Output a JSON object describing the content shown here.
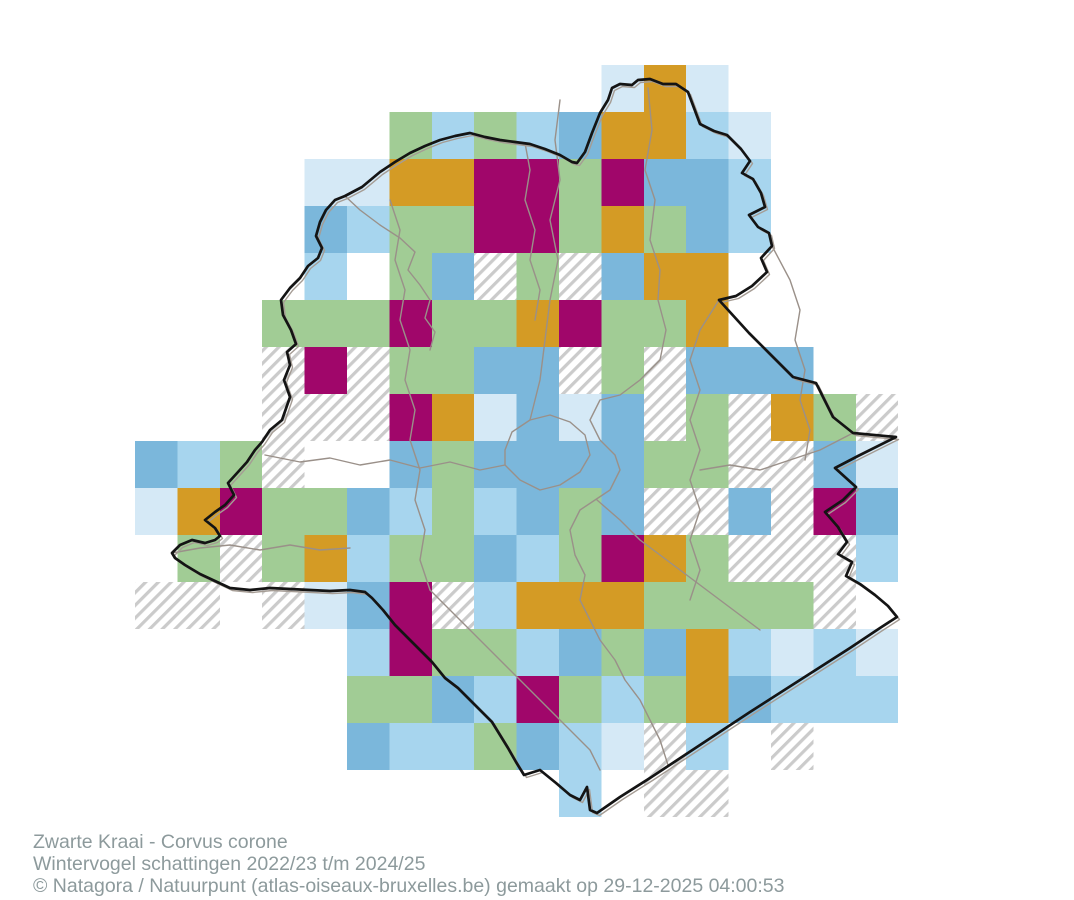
{
  "page": {
    "background": "#FFFFFF"
  },
  "caption": {
    "species": "Zwarte Kraai - Corvus corone",
    "subtitle": "Wintervogel schattingen 2022/23 t/m 2024/25",
    "copyright": "© Natagora / Natuurpunt (atlas-oiseaux-bruxelles.be) gemaakt op 29-12-2025 04:00:53",
    "text_color": "#8D9A9C"
  },
  "map": {
    "grid": {
      "columns": 18,
      "rows": 16,
      "origin_x": 135,
      "origin_y": 65,
      "cell_width": 42.4,
      "cell_height": 47,
      "cells": [
        "WWWWWWWWWWWPOPWWWW",
        "WWWWWWGLGLMOOLPWWW",
        "WWWWPPOOXXGXMMLWWW",
        "WWWWMLGGXXGOGMLWWW",
        "WWWWLWGMHGHMOOWWWW",
        "WWWGGGXGGOXGGOWWWW",
        "WWWHXHGGMMHGHMMMWW",
        "WWWHHHXOPMPMHGHOGH",
        "MLGHWWMGMMMMGGHHMP",
        "POXGGMLGLMGMHHMHXM",
        "WGHGOLGGMLGXOGHHHL",
        "HHWHPMXHLOOOGGGGHW",
        "WWWWWLXGGLMGMOLPLP",
        "WWWWWGGMLXGLGOMLLL",
        "WWWWWMLLGMLPHLWHWW",
        "WWWWWWWWWWLWHHWWWW"
      ],
      "palette": {
        "W": null,
        "H": "hatch",
        "P": "#D5E9F6",
        "L": "#A7D5EE",
        "M": "#7BB7DB",
        "G": "#A1CC95",
        "O": "#D49B25",
        "X": "#A0066A"
      },
      "hatch_line_color": "#CBCBCB"
    },
    "outline_color": "#141414",
    "outline_shadow_color": "#A59C94",
    "boundary_color": "#9A9089",
    "outline": [
      [
        608,
        100
      ],
      [
        612,
        88
      ],
      [
        620,
        84
      ],
      [
        632,
        85
      ],
      [
        638,
        80
      ],
      [
        650,
        79
      ],
      [
        663,
        84
      ],
      [
        676,
        84
      ],
      [
        688,
        92
      ],
      [
        694,
        108
      ],
      [
        700,
        124
      ],
      [
        714,
        131
      ],
      [
        727,
        135
      ],
      [
        741,
        149
      ],
      [
        750,
        161
      ],
      [
        742,
        173
      ],
      [
        753,
        179
      ],
      [
        761,
        193
      ],
      [
        765,
        207
      ],
      [
        749,
        215
      ],
      [
        758,
        227
      ],
      [
        769,
        233
      ],
      [
        772,
        246
      ],
      [
        761,
        258
      ],
      [
        767,
        272
      ],
      [
        752,
        286
      ],
      [
        736,
        296
      ],
      [
        719,
        300
      ],
      [
        749,
        333
      ],
      [
        769,
        353
      ],
      [
        793,
        377
      ],
      [
        816,
        383
      ],
      [
        833,
        417
      ],
      [
        853,
        433
      ],
      [
        896,
        437
      ],
      [
        858,
        456
      ],
      [
        835,
        468
      ],
      [
        856,
        487
      ],
      [
        843,
        500
      ],
      [
        825,
        512
      ],
      [
        838,
        527
      ],
      [
        847,
        542
      ],
      [
        838,
        554
      ],
      [
        852,
        562
      ],
      [
        846,
        576
      ],
      [
        860,
        584
      ],
      [
        875,
        595
      ],
      [
        888,
        606
      ],
      [
        897,
        617
      ],
      [
        880,
        628
      ],
      [
        850,
        648
      ],
      [
        800,
        680
      ],
      [
        750,
        712
      ],
      [
        700,
        745
      ],
      [
        650,
        778
      ],
      [
        620,
        797
      ],
      [
        597,
        813
      ],
      [
        590,
        810
      ],
      [
        587,
        787
      ],
      [
        580,
        800
      ],
      [
        570,
        795
      ],
      [
        556,
        783
      ],
      [
        540,
        770
      ],
      [
        524,
        775
      ],
      [
        516,
        762
      ],
      [
        508,
        748
      ],
      [
        500,
        735
      ],
      [
        492,
        722
      ],
      [
        480,
        710
      ],
      [
        470,
        700
      ],
      [
        458,
        688
      ],
      [
        445,
        678
      ],
      [
        432,
        662
      ],
      [
        420,
        650
      ],
      [
        406,
        636
      ],
      [
        395,
        625
      ],
      [
        383,
        610
      ],
      [
        372,
        598
      ],
      [
        365,
        592
      ],
      [
        350,
        590
      ],
      [
        330,
        591
      ],
      [
        310,
        590
      ],
      [
        290,
        589
      ],
      [
        270,
        588
      ],
      [
        250,
        590
      ],
      [
        230,
        588
      ],
      [
        215,
        581
      ],
      [
        200,
        574
      ],
      [
        185,
        565
      ],
      [
        175,
        558
      ],
      [
        172,
        553
      ],
      [
        180,
        545
      ],
      [
        192,
        540
      ],
      [
        205,
        543
      ],
      [
        215,
        540
      ],
      [
        220,
        536
      ],
      [
        215,
        528
      ],
      [
        205,
        520
      ],
      [
        215,
        512
      ],
      [
        225,
        505
      ],
      [
        234,
        495
      ],
      [
        228,
        483
      ],
      [
        238,
        472
      ],
      [
        247,
        462
      ],
      [
        255,
        450
      ],
      [
        262,
        442
      ],
      [
        270,
        430
      ],
      [
        282,
        420
      ],
      [
        290,
        397
      ],
      [
        284,
        380
      ],
      [
        290,
        365
      ],
      [
        287,
        352
      ],
      [
        296,
        344
      ],
      [
        291,
        330
      ],
      [
        283,
        315
      ],
      [
        281,
        300
      ],
      [
        290,
        288
      ],
      [
        300,
        278
      ],
      [
        308,
        266
      ],
      [
        318,
        258
      ],
      [
        322,
        248
      ],
      [
        316,
        236
      ],
      [
        320,
        222
      ],
      [
        326,
        210
      ],
      [
        335,
        200
      ],
      [
        345,
        196
      ],
      [
        362,
        187
      ],
      [
        380,
        172
      ],
      [
        395,
        162
      ],
      [
        410,
        153
      ],
      [
        425,
        146
      ],
      [
        440,
        140
      ],
      [
        455,
        136
      ],
      [
        470,
        133
      ],
      [
        485,
        137
      ],
      [
        500,
        140
      ],
      [
        515,
        142
      ],
      [
        530,
        144
      ],
      [
        545,
        149
      ],
      [
        560,
        155
      ],
      [
        572,
        162
      ],
      [
        577,
        163
      ],
      [
        585,
        152
      ],
      [
        592,
        133
      ],
      [
        600,
        113
      ]
    ],
    "boundaries": [
      [
        [
          648,
          88
        ],
        [
          652,
          130
        ],
        [
          645,
          170
        ],
        [
          655,
          200
        ],
        [
          650,
          240
        ],
        [
          660,
          270
        ],
        [
          658,
          300
        ],
        [
          666,
          330
        ],
        [
          660,
          360
        ],
        [
          640,
          380
        ],
        [
          620,
          395
        ],
        [
          600,
          400
        ],
        [
          590,
          420
        ],
        [
          600,
          440
        ],
        [
          615,
          455
        ],
        [
          620,
          470
        ],
        [
          610,
          490
        ],
        [
          595,
          500
        ],
        [
          580,
          510
        ],
        [
          570,
          530
        ],
        [
          575,
          555
        ],
        [
          585,
          575
        ],
        [
          580,
          600
        ],
        [
          590,
          620
        ],
        [
          600,
          640
        ],
        [
          615,
          660
        ],
        [
          625,
          680
        ],
        [
          640,
          700
        ],
        [
          650,
          720
        ],
        [
          660,
          740
        ],
        [
          668,
          765
        ]
      ],
      [
        [
          390,
          200
        ],
        [
          400,
          230
        ],
        [
          395,
          260
        ],
        [
          405,
          290
        ],
        [
          400,
          320
        ],
        [
          410,
          350
        ],
        [
          405,
          380
        ],
        [
          415,
          410
        ],
        [
          410,
          440
        ],
        [
          420,
          470
        ],
        [
          415,
          500
        ],
        [
          425,
          530
        ],
        [
          420,
          560
        ],
        [
          430,
          590
        ]
      ],
      [
        [
          265,
          455
        ],
        [
          300,
          462
        ],
        [
          330,
          458
        ],
        [
          360,
          465
        ],
        [
          390,
          460
        ],
        [
          420,
          468
        ],
        [
          450,
          462
        ],
        [
          480,
          470
        ],
        [
          505,
          465
        ]
      ],
      [
        [
          505,
          465
        ],
        [
          520,
          480
        ],
        [
          540,
          490
        ],
        [
          560,
          485
        ],
        [
          580,
          472
        ],
        [
          590,
          455
        ],
        [
          585,
          435
        ],
        [
          570,
          422
        ],
        [
          550,
          415
        ],
        [
          530,
          420
        ],
        [
          512,
          432
        ],
        [
          505,
          450
        ],
        [
          505,
          465
        ]
      ],
      [
        [
          560,
          100
        ],
        [
          555,
          140
        ],
        [
          560,
          180
        ],
        [
          550,
          220
        ],
        [
          558,
          260
        ],
        [
          550,
          300
        ],
        [
          545,
          340
        ],
        [
          540,
          380
        ],
        [
          530,
          420
        ]
      ],
      [
        [
          719,
          300
        ],
        [
          700,
          330
        ],
        [
          690,
          360
        ],
        [
          700,
          390
        ],
        [
          690,
          420
        ],
        [
          700,
          450
        ],
        [
          690,
          480
        ],
        [
          700,
          510
        ],
        [
          690,
          540
        ],
        [
          700,
          570
        ],
        [
          690,
          600
        ]
      ],
      [
        [
          772,
          246
        ],
        [
          790,
          280
        ],
        [
          800,
          310
        ],
        [
          795,
          340
        ],
        [
          805,
          370
        ],
        [
          800,
          400
        ],
        [
          810,
          430
        ],
        [
          805,
          460
        ]
      ],
      [
        [
          853,
          433
        ],
        [
          820,
          450
        ],
        [
          790,
          460
        ],
        [
          760,
          470
        ],
        [
          730,
          465
        ],
        [
          700,
          470
        ]
      ],
      [
        [
          172,
          553
        ],
        [
          200,
          548
        ],
        [
          230,
          545
        ],
        [
          260,
          550
        ],
        [
          290,
          545
        ],
        [
          320,
          550
        ],
        [
          350,
          548
        ]
      ],
      [
        [
          597,
          500
        ],
        [
          620,
          520
        ],
        [
          640,
          540
        ],
        [
          660,
          555
        ],
        [
          680,
          570
        ],
        [
          700,
          585
        ],
        [
          720,
          600
        ],
        [
          740,
          615
        ],
        [
          760,
          630
        ]
      ],
      [
        [
          430,
          590
        ],
        [
          450,
          610
        ],
        [
          470,
          630
        ],
        [
          490,
          650
        ],
        [
          510,
          670
        ],
        [
          530,
          690
        ],
        [
          550,
          710
        ],
        [
          570,
          730
        ],
        [
          590,
          750
        ],
        [
          600,
          770
        ]
      ],
      [
        [
          525,
          143
        ],
        [
          530,
          170
        ],
        [
          525,
          200
        ],
        [
          535,
          230
        ],
        [
          530,
          260
        ],
        [
          540,
          290
        ],
        [
          535,
          320
        ]
      ],
      [
        [
          345,
          196
        ],
        [
          360,
          210
        ],
        [
          380,
          225
        ],
        [
          400,
          238
        ],
        [
          415,
          252
        ],
        [
          408,
          270
        ],
        [
          420,
          285
        ],
        [
          430,
          300
        ],
        [
          425,
          318
        ],
        [
          435,
          332
        ],
        [
          430,
          350
        ]
      ]
    ]
  }
}
